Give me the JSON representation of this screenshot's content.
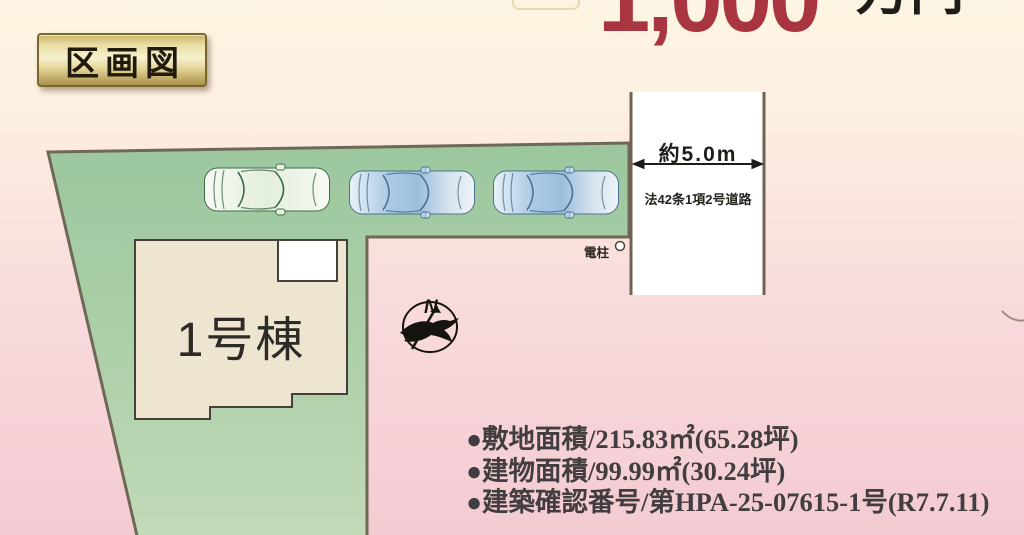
{
  "header": {
    "title_badge": "区画図",
    "price": {
      "amount": "1,000",
      "unit": "万円"
    }
  },
  "plot": {
    "building_label": "1号棟",
    "road": {
      "width_label": "約5.0m",
      "type_label": "法42条1項2号道路"
    },
    "utility_pole_label": "電柱",
    "compass_label": "N",
    "parked_cars_count": 3
  },
  "details": {
    "items": [
      "●敷地面積/215.83㎡(65.28坪)",
      "●建物面積/99.99㎡(30.24坪)",
      "●建築確認番号/第HPA-25-07615-1号(R7.7.11)"
    ]
  },
  "colors": {
    "background_top": "#fdf5e3",
    "background_bottom": "#f3cbd2",
    "plot_green": "#a3cba4",
    "plot_border": "#6f6857",
    "building_fill": "#ede5cf",
    "building_border": "#43413a",
    "road_fill": "#ffffff",
    "road_border": "#6f6253",
    "price_red": "#a93540",
    "badge_gold": "#e9dda4",
    "car_blue": "#a9c8e2",
    "car_green_outline": "#3d6b46"
  }
}
